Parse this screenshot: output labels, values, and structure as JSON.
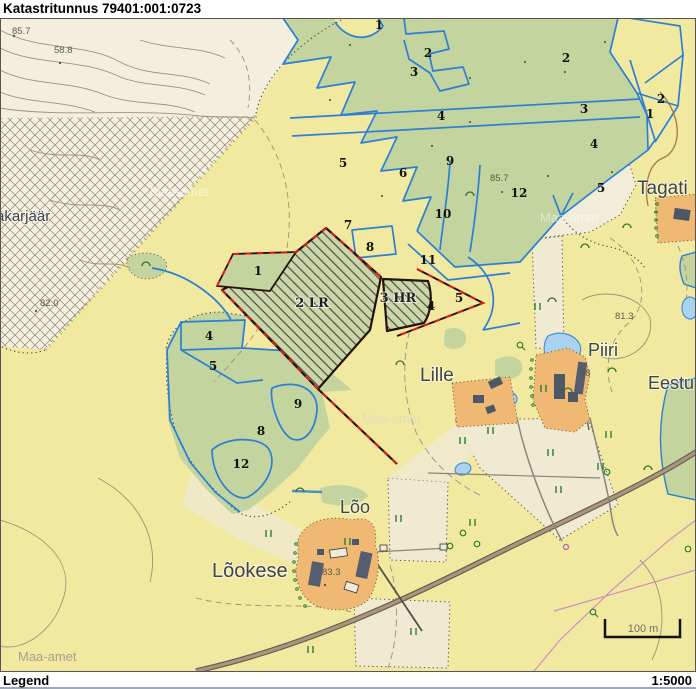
{
  "header": {
    "title": "Katastritunnus 79401:001:0723"
  },
  "footer": {
    "legend": "Legend",
    "scale": "1:5000"
  },
  "map": {
    "watermark": "Maa-amet",
    "scale_bar": "100 m",
    "parcel_labels": [
      {
        "text": "2 LR"
      },
      {
        "text": "3 HR"
      }
    ],
    "place_names": [
      {
        "text": "Tagati"
      },
      {
        "text": "Piiri"
      },
      {
        "text": "Eestu"
      },
      {
        "text": "Lille"
      },
      {
        "text": "Lõo"
      },
      {
        "text": "Lõokese"
      },
      {
        "text": "akarjäär"
      }
    ],
    "elevations": [
      {
        "text": "85.7"
      },
      {
        "text": "58.8"
      },
      {
        "text": "82.0"
      },
      {
        "text": "85.7"
      },
      {
        "text": "81.3"
      },
      {
        "text": "83.3"
      },
      {
        "text": "08"
      }
    ],
    "plot_numbers": [
      "1",
      "2",
      "3",
      "4",
      "5",
      "6",
      "9",
      "10",
      "7",
      "8",
      "11",
      "12",
      "2",
      "3",
      "4",
      "1",
      "2",
      "5",
      "1",
      "4",
      "5",
      "4",
      "5",
      "9",
      "8",
      "12"
    ],
    "colors": {
      "background": "#f2e9a0",
      "forest": "#c3d49e",
      "open_land": "#f2edd8",
      "farm_yard": "#efb873",
      "water": "#a9d3ee",
      "parcel_line": "#2b7fd6",
      "cadastral_boundary": "#241208",
      "cadastral_highlight": "#e21b1b",
      "road": "#a4937e"
    }
  }
}
